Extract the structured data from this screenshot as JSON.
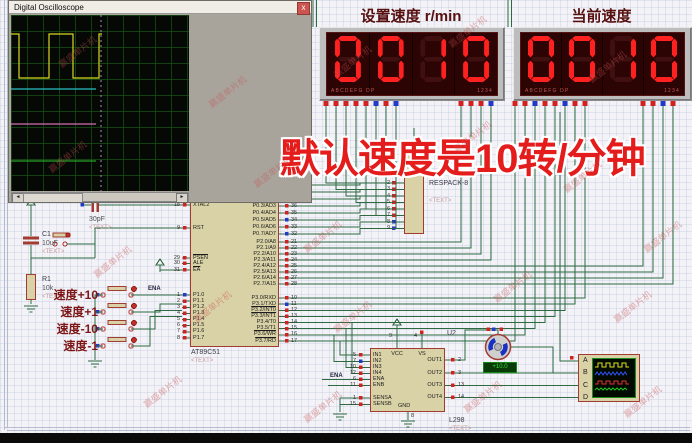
{
  "scope": {
    "title": "Digital Oscilloscope",
    "close": "x",
    "trigger": {
      "header": "Trigger",
      "level": "Level",
      "values": [
        "-20",
        "-10",
        "0"
      ],
      "ac": "AC",
      "dc": "DC",
      "auto": "Auto",
      "one_shot": "One-Shot",
      "cursors": "Cursors",
      "source": "Source",
      "sources": [
        "A",
        "B",
        "C",
        "D"
      ]
    },
    "horizontal": {
      "header": "Horizontal",
      "source": "Source",
      "sources": [
        "A",
        "B",
        "C",
        "D"
      ],
      "position": "Position",
      "values": [
        "210",
        "200",
        "190"
      ]
    },
    "channels": [
      {
        "header": "Channel A",
        "position": "Position",
        "values": [
          "100",
          "110",
          "120"
        ],
        "coupling": [
          "AC",
          "DC",
          "GND",
          "OFF"
        ],
        "invert": "Invert",
        "combine": "A+B",
        "accent": "#d8d820"
      },
      {
        "header": "Channel C",
        "position": "Position",
        "values": [
          "-50",
          "-40",
          "-30"
        ],
        "coupling": [
          "AC",
          "DC",
          "GND",
          "OFF"
        ],
        "invert": "Invert",
        "combine": "C+D",
        "accent": "#e048e0"
      },
      {
        "header": "Channel B",
        "position": "Position",
        "values": [
          "30",
          "40",
          "50"
        ],
        "coupling": [
          "AC",
          "DC",
          "GND",
          "OFF"
        ],
        "invert": "Invert",
        "combine": "",
        "accent": "#4888ff"
      },
      {
        "header": "Channel D",
        "position": "Position",
        "values": [
          "-130",
          "-120",
          "-110"
        ],
        "coupling": [
          "AC",
          "DC",
          "GND",
          "OFF"
        ],
        "invert": "Invert",
        "combine": "",
        "accent": "#28b028"
      }
    ],
    "source_colors": [
      "#b8b820",
      "#4888ff",
      "#e048e0",
      "#28b028"
    ]
  },
  "panels": [
    {
      "title": "设置速度 r/min",
      "value": "0010",
      "seg_legend": "ABCDEFG  DP",
      "digit_legend": "1234"
    },
    {
      "title": "当前速度",
      "value": "0010",
      "seg_legend": "ABCDEFG  DP",
      "digit_legend": "1234"
    }
  ],
  "overlay": "默认速度是10转/分钟",
  "watermark": "赢盛单片机",
  "mcu": {
    "ref": "AT89C51",
    "text": "<TEXT>",
    "left": [
      {
        "n": "18",
        "l": "XTAL2"
      },
      {
        "n": "9",
        "l": "RST"
      },
      {
        "n": "29",
        "l": "PSEN",
        "ov": true
      },
      {
        "n": "30",
        "l": "ALE"
      },
      {
        "n": "31",
        "l": "EA",
        "ov": true
      },
      {
        "n": "1",
        "l": "P1.0"
      },
      {
        "n": "2",
        "l": "P1.1"
      },
      {
        "n": "3",
        "l": "P1.2"
      },
      {
        "n": "4",
        "l": "P1.3"
      },
      {
        "n": "5",
        "l": "P1.4"
      },
      {
        "n": "6",
        "l": "P1.5"
      },
      {
        "n": "7",
        "l": "P1.6"
      },
      {
        "n": "8",
        "l": "P1.7"
      }
    ],
    "right": [
      {
        "n": "39",
        "l": "P0.0/AD0"
      },
      {
        "n": "38",
        "l": "P0.1/AD1"
      },
      {
        "n": "37",
        "l": "P0.2/AD2"
      },
      {
        "n": "36",
        "l": "P0.3/AD3"
      },
      {
        "n": "35",
        "l": "P0.4/AD4"
      },
      {
        "n": "34",
        "l": "P0.5/AD5"
      },
      {
        "n": "33",
        "l": "P0.6/AD6"
      },
      {
        "n": "32",
        "l": "P0.7/AD7"
      },
      {
        "n": "21",
        "l": "P2.0/A8"
      },
      {
        "n": "22",
        "l": "P2.1/A9"
      },
      {
        "n": "23",
        "l": "P2.2/A10"
      },
      {
        "n": "24",
        "l": "P2.3/A11"
      },
      {
        "n": "25",
        "l": "P2.4/A12"
      },
      {
        "n": "26",
        "l": "P2.5/A13"
      },
      {
        "n": "27",
        "l": "P2.6/A14"
      },
      {
        "n": "28",
        "l": "P2.7/A15"
      },
      {
        "n": "10",
        "l": "P3.0/RXD"
      },
      {
        "n": "11",
        "l": "P3.1/TXD"
      },
      {
        "n": "12",
        "l": "P3.2/INT0",
        "ov": true
      },
      {
        "n": "13",
        "l": "P3.3/INT1",
        "ov": true
      },
      {
        "n": "14",
        "l": "P3.4/T0"
      },
      {
        "n": "15",
        "l": "P3.5/T1"
      },
      {
        "n": "16",
        "l": "P3.6/WR",
        "ov": true
      },
      {
        "n": "17",
        "l": "P3.7/RD",
        "ov": true
      }
    ]
  },
  "respack": {
    "ref": "RESPACK-8",
    "text": "<TEXT>",
    "pins": [
      "2",
      "3",
      "4",
      "5",
      "6",
      "7",
      "8",
      "9"
    ]
  },
  "l298": {
    "ref": "L298",
    "text": "<TEXT>",
    "left": [
      {
        "n": "5",
        "l": "IN1"
      },
      {
        "n": "7",
        "l": "IN2"
      },
      {
        "n": "10",
        "l": "IN3"
      },
      {
        "n": "12",
        "l": "IN4"
      },
      {
        "n": "6",
        "l": "ENA"
      },
      {
        "n": "11",
        "l": "ENB"
      },
      {
        "n": "1",
        "l": "SENSA"
      },
      {
        "n": "15",
        "l": "SENSB"
      }
    ],
    "right": [
      {
        "n": "2",
        "l": "OUT1"
      },
      {
        "n": "3",
        "l": "OUT2"
      },
      {
        "n": "13",
        "l": "OUT3"
      },
      {
        "n": "14",
        "l": "OUT4"
      }
    ],
    "top": [
      {
        "n": "9",
        "l": "VCC"
      },
      {
        "n": "4",
        "l": "VS"
      }
    ],
    "bottom": [
      {
        "n": "8",
        "l": "GND"
      }
    ]
  },
  "motor": {
    "ref": "U2",
    "readout": "+10.0"
  },
  "push_buttons": [
    "速度+10",
    "速度+1",
    "速度-10",
    "速度-1"
  ],
  "parts": {
    "c1_ref": "C1",
    "c1_val": "10uF",
    "r1_ref": "R1",
    "r1_val": "10k",
    "c2_val": "30pF",
    "text": "<TEXT>",
    "ena": "ENA"
  },
  "probe": {
    "inputs": [
      "A",
      "B",
      "C",
      "D"
    ]
  }
}
